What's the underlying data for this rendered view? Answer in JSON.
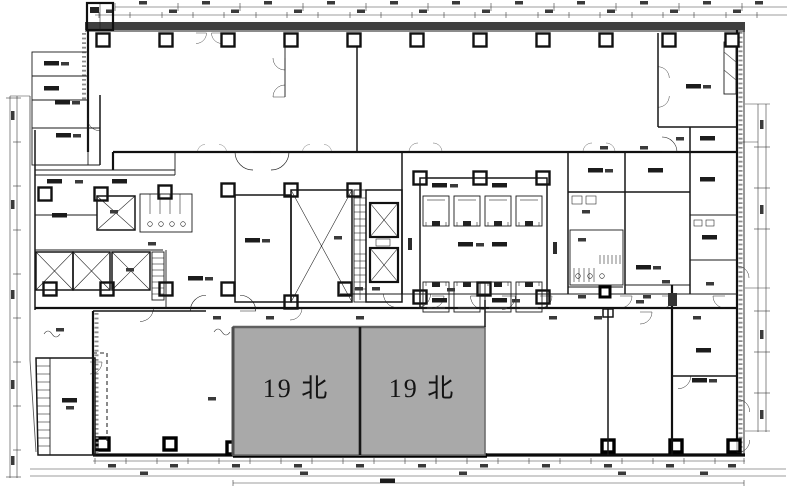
{
  "floor_plan": {
    "description": "office-building-typical-floor-plan",
    "units": [
      {
        "id": "unit-a",
        "label": "19 北"
      },
      {
        "id": "unit-b",
        "label": "19 北"
      }
    ],
    "colors": {
      "highlight": "#a9a9a9",
      "line": "#1a1a1a",
      "wall_fill": "#3f3f3f"
    }
  }
}
